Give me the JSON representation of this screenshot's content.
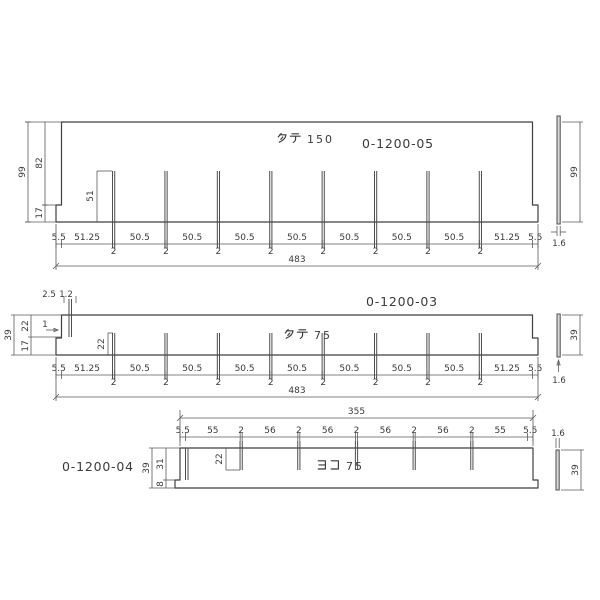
{
  "page": {
    "background": "#ffffff",
    "line_color": "#4d4d4d",
    "dim_text_color": "#3a3a3a",
    "part_no_color": "#c0443e"
  },
  "drawings": [
    {
      "title": "タテ 150",
      "title_kana": "タテ",
      "title_num": "150",
      "part_no": "0-1200-05",
      "dims": [
        "5.5",
        "51.25",
        "2",
        "50.5",
        "2",
        "50.5",
        "2",
        "50.5",
        "2",
        "50.5",
        "2",
        "50.5",
        "2",
        "50.5",
        "2",
        "50.5",
        "2",
        "51.25",
        "5.5"
      ],
      "total": "483",
      "fin_height": "51",
      "left_dims": {
        "overall": "99",
        "upper": "82",
        "lower": "17"
      },
      "side": {
        "height": "99",
        "thickness": "1.6"
      }
    },
    {
      "title": "タテ 75",
      "title_kana": "タテ",
      "title_num": "75",
      "part_no": "0-1200-03",
      "dims": [
        "5.5",
        "51.25",
        "2",
        "50.5",
        "2",
        "50.5",
        "2",
        "50.5",
        "2",
        "50.5",
        "2",
        "50.5",
        "2",
        "50.5",
        "2",
        "50.5",
        "2",
        "51.25",
        "5.5"
      ],
      "total": "483",
      "fin_height": "22",
      "left_dims": {
        "overall": "39",
        "upper": "22",
        "lower": "17"
      },
      "top_small_dims": [
        "2.5",
        "1.2"
      ],
      "step_dim": "1",
      "side": {
        "height": "39",
        "thickness": "1.6"
      }
    },
    {
      "title": "ヨコ 75",
      "title_kana": "ヨコ",
      "title_num": "75",
      "part_no": "0-1200-04",
      "dims": [
        "5.5",
        "55",
        "2",
        "56",
        "2",
        "56",
        "2",
        "56",
        "2",
        "56",
        "2",
        "55",
        "5.5"
      ],
      "total": "355",
      "fin_height": "22",
      "left_dims": {
        "overall": "39",
        "upper": "31",
        "lower": "8"
      },
      "side": {
        "height": "39",
        "thickness": "1.6"
      }
    }
  ]
}
